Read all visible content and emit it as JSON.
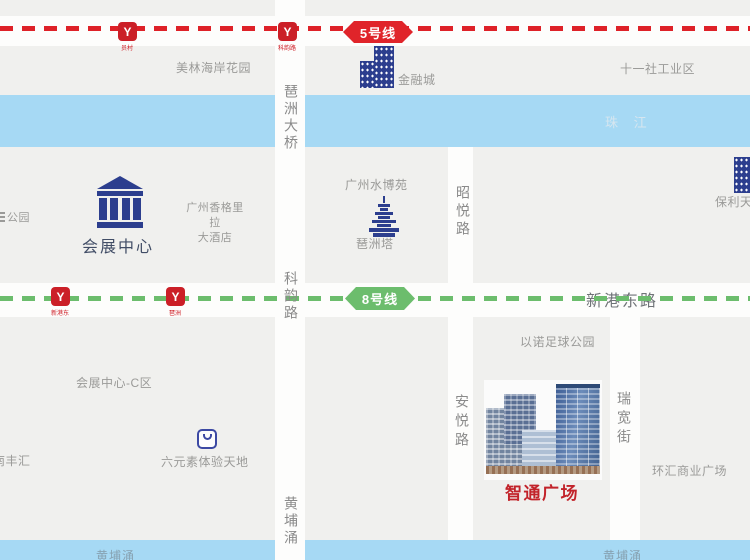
{
  "colors": {
    "background": "#f0f0ee",
    "road": "#fdfdfc",
    "river": "#a6d9f4",
    "line5_red": "#de2128",
    "line8_green": "#6cbd6d",
    "station_red": "#cb1f27",
    "poi_navy": "#2c3e8e",
    "gray_text": "#9a9a98",
    "highlight_red": "#c2232a"
  },
  "metro": {
    "logo_glyph": "Y",
    "line5": {
      "badge": "5号线",
      "stations": [
        "员村",
        "科韵路"
      ]
    },
    "line8": {
      "badge": "8号线",
      "stations": [
        "新港东",
        "琶洲"
      ]
    }
  },
  "roads": {
    "xingang_east": "新港东路",
    "pazhou_bridge": "琶洲大桥",
    "keyun": "科韵路",
    "huangpuyong_bridge": "黄埔涌",
    "zhaoyue": "昭悦路",
    "anyue": "安悦路",
    "ruikuan": "瑞宽街"
  },
  "rivers": {
    "zhujiang": "珠 江",
    "huangpuyong": "黄埔涌"
  },
  "places": {
    "meilin": "美林海岸花园",
    "jinrongcheng": "金融城",
    "shiyishe": "十一社工业区",
    "park_partial": "公园",
    "huizhan_center": "会展中心",
    "shangrila_line1": "广州香格里拉",
    "shangrila_line2": "大酒店",
    "shuiboyuan": "广州水博苑",
    "pazhou_ta": "琶洲塔",
    "baoli_partial": "保利天",
    "huizhan_c": "会展中心-C区",
    "nanfenghui": "南丰汇",
    "liuyuansu": "六元素体验天地",
    "yinuo": "以诺足球公园",
    "zhitong": "智通广场",
    "huanhui": "环汇商业广场"
  }
}
